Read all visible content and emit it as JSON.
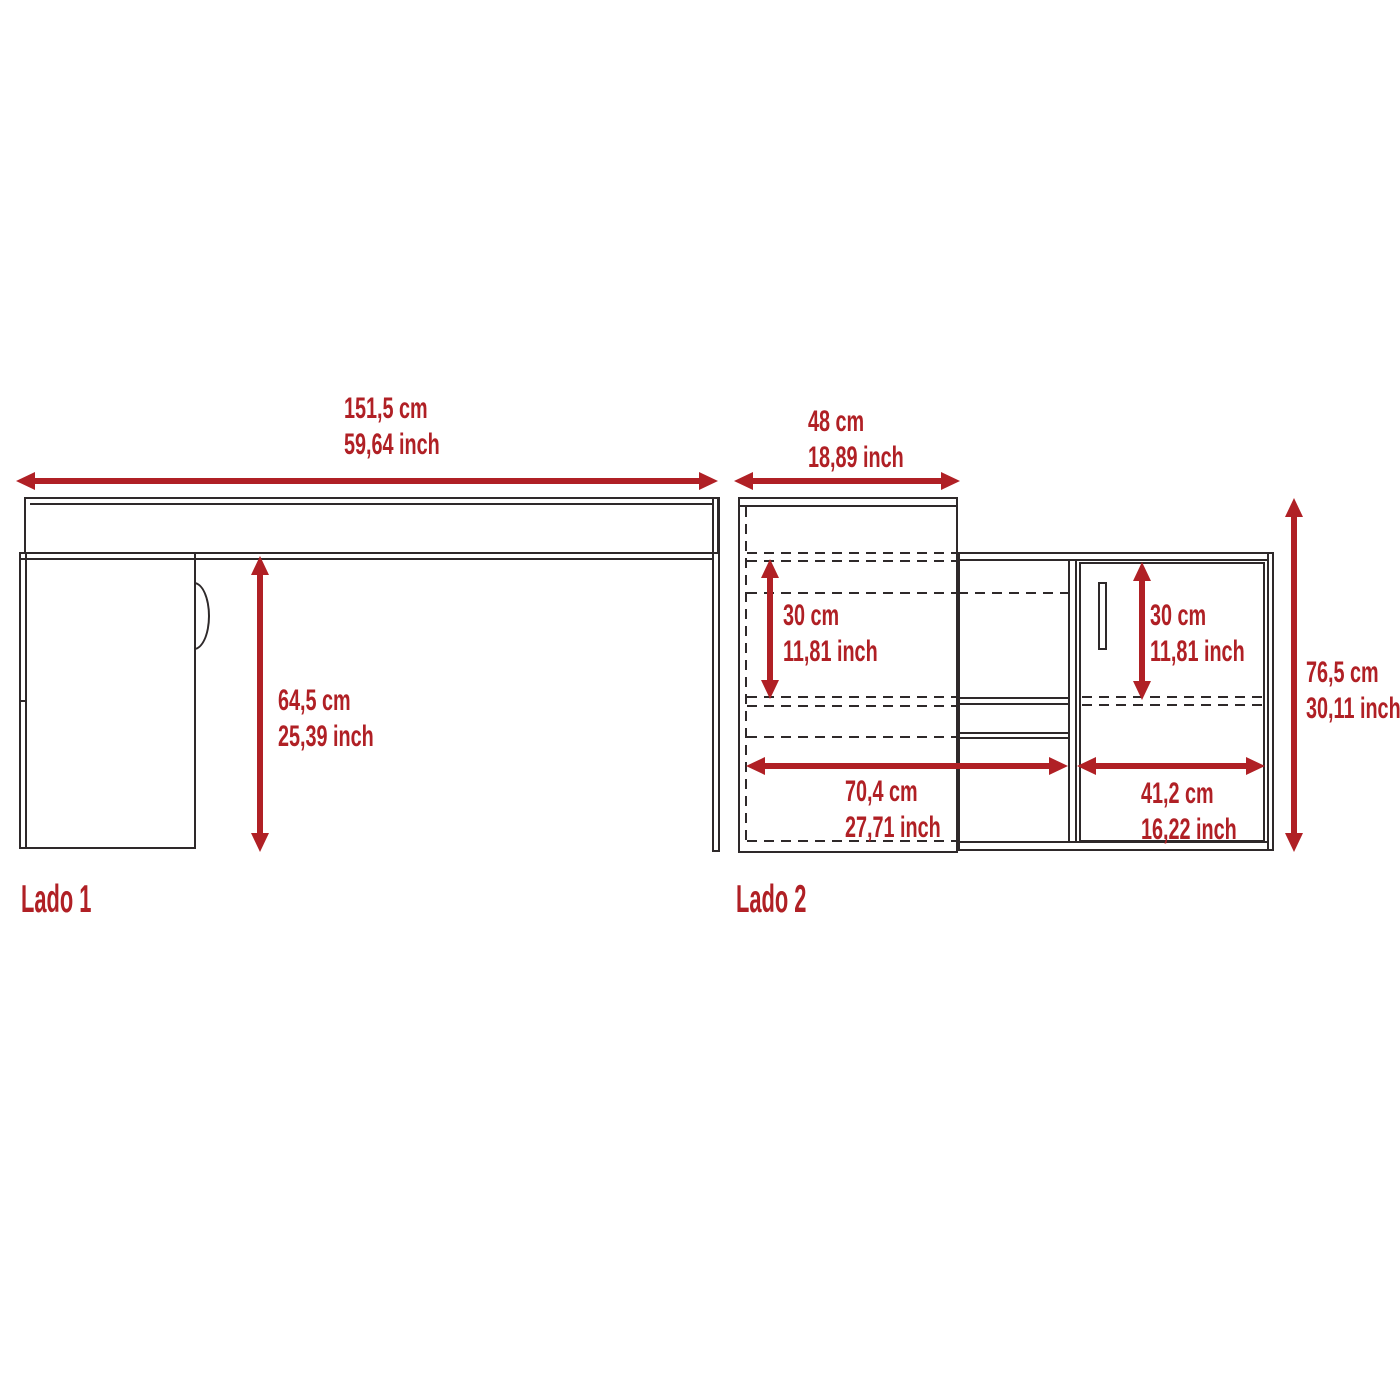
{
  "colors": {
    "dimension_red": "#b02025",
    "line": "#2e292a",
    "background": "#ffffff"
  },
  "views": {
    "lado1": {
      "label": "Lado 1",
      "width": {
        "cm": "151,5 cm",
        "inch": "59,64 inch"
      },
      "underdesk_height": {
        "cm": "64,5 cm",
        "inch": "25,39 inch"
      }
    },
    "lado2": {
      "label": "Lado 2",
      "depth": {
        "cm": "48 cm",
        "inch": "18,89 inch"
      },
      "left_shelf_height": {
        "cm": "30 cm",
        "inch": "11,81 inch"
      },
      "door_height": {
        "cm": "30 cm",
        "inch": "11,81 inch"
      },
      "total_height": {
        "cm": "76,5 cm",
        "inch": "30,11 inch"
      },
      "open_section_width": {
        "cm": "70,4 cm",
        "inch": "27,71 inch"
      },
      "door_width": {
        "cm": "41,2 cm",
        "inch": "16,22 inch"
      }
    }
  }
}
